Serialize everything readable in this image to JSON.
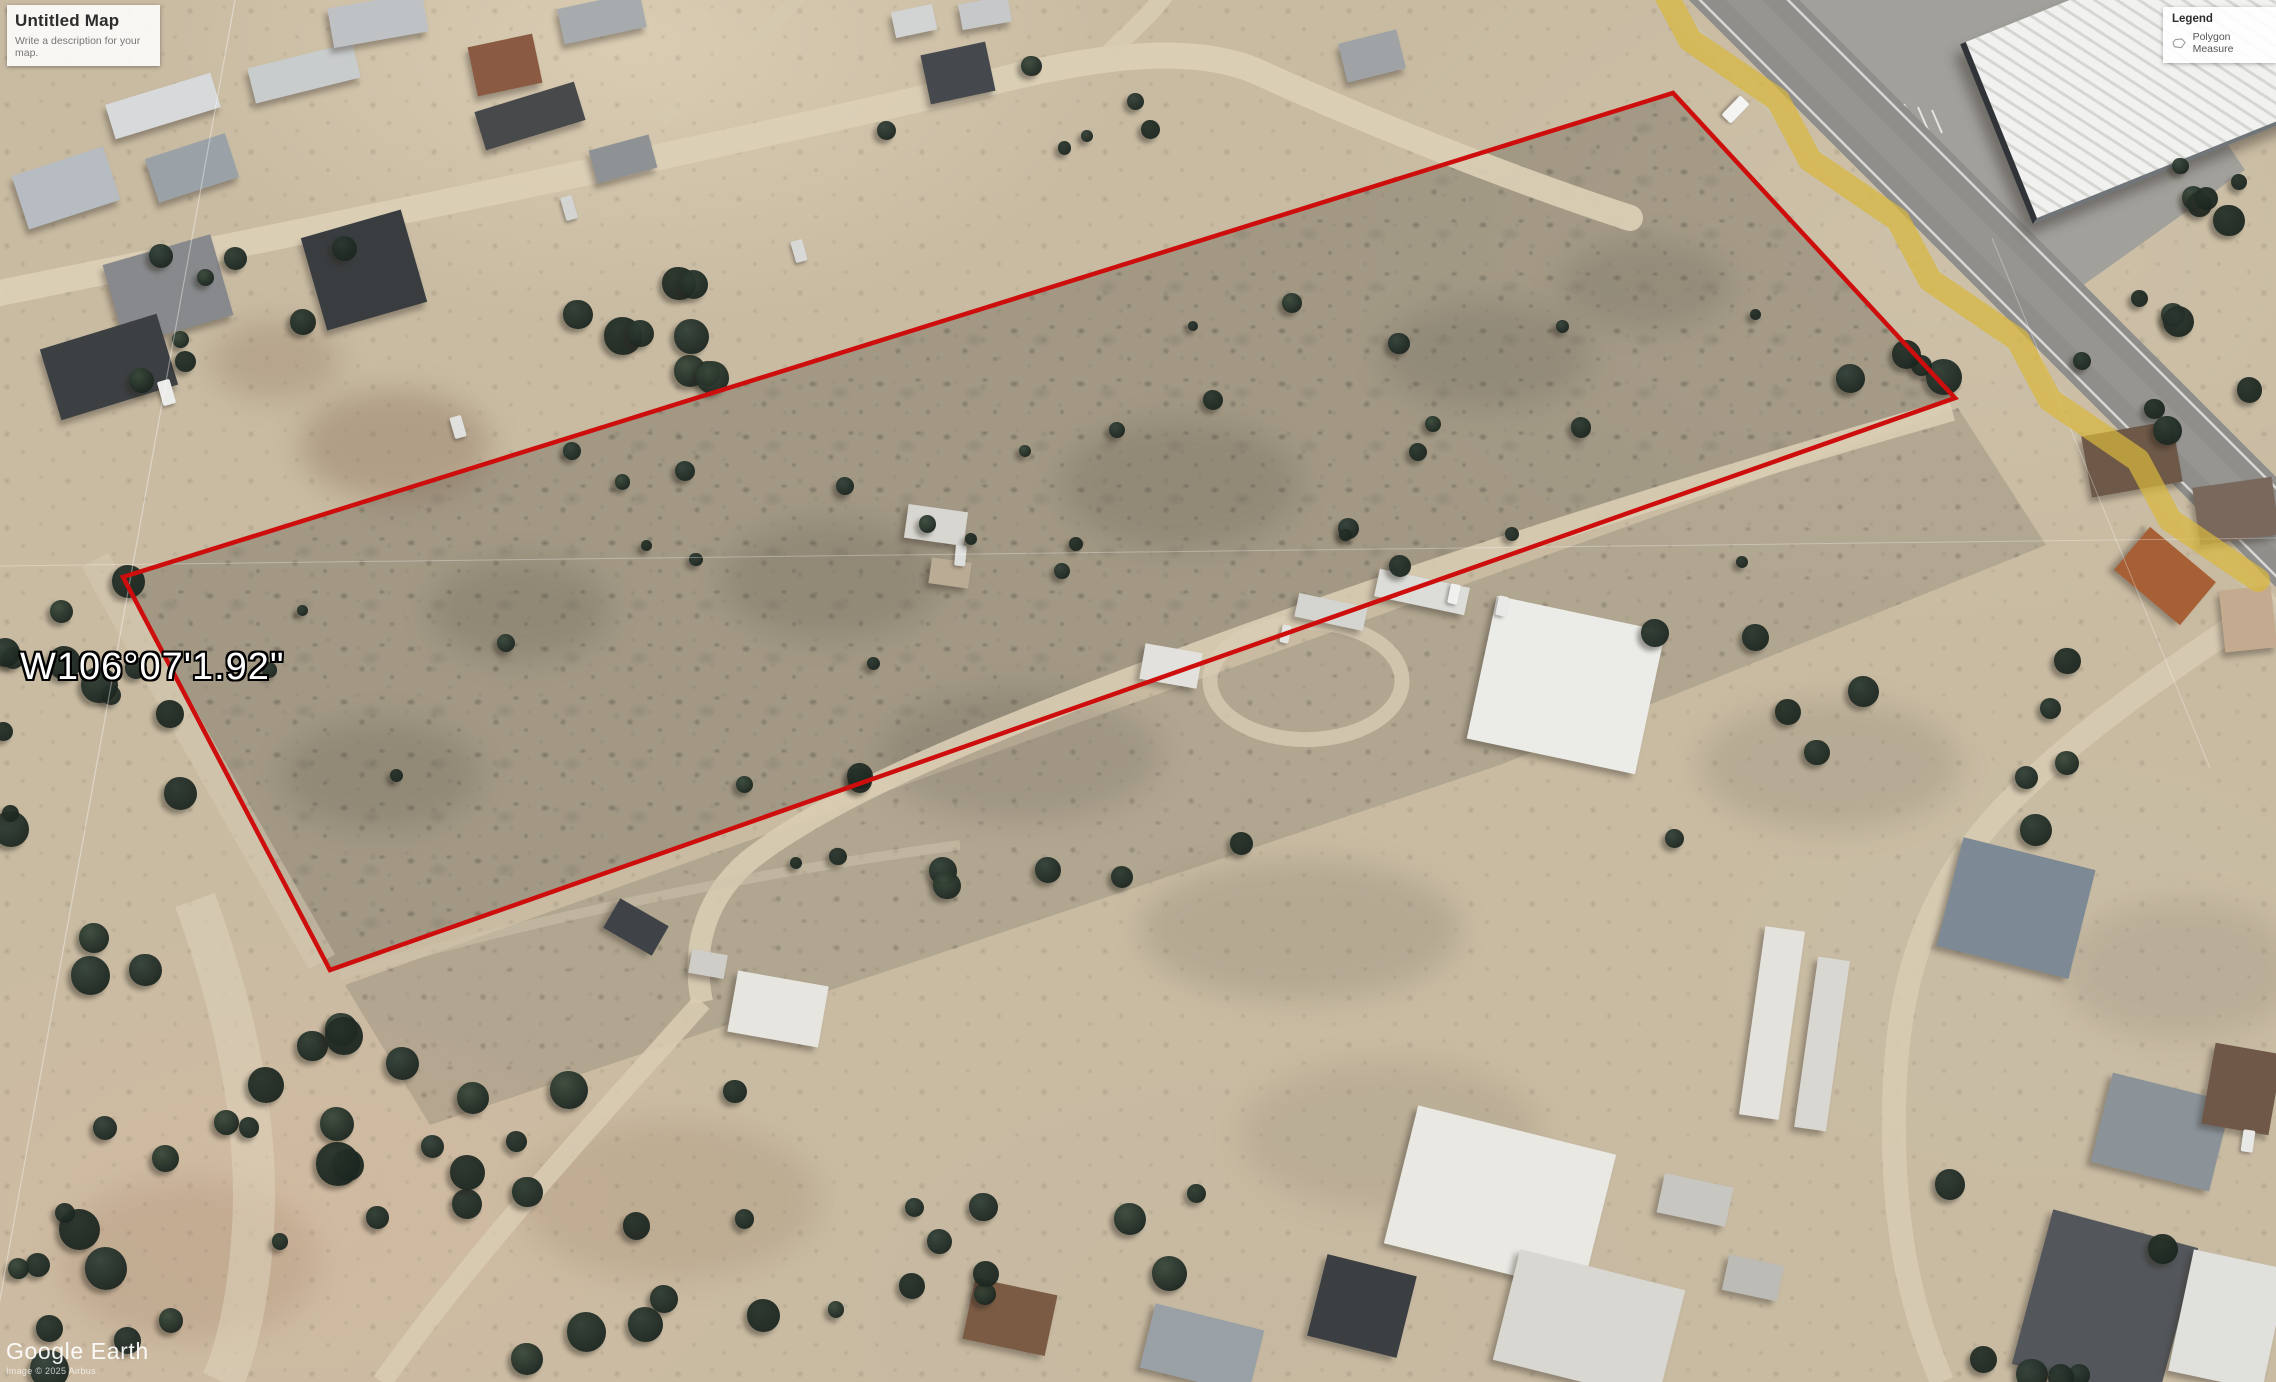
{
  "title_panel": {
    "title": "Untitled Map",
    "subtitle": "Write a description for your map."
  },
  "legend_panel": {
    "title": "Legend",
    "items": [
      {
        "icon": "polygon-icon",
        "label": "Polygon Measure"
      }
    ]
  },
  "map_overlay": {
    "coordinate_label": "W106°07'1.92\"",
    "parcel_outline_color": "#ce0d0d",
    "measure_line_color": "#d8b73e"
  },
  "branding": {
    "logo": "Google Earth",
    "copyright": "Image © 2025 Airbus"
  }
}
